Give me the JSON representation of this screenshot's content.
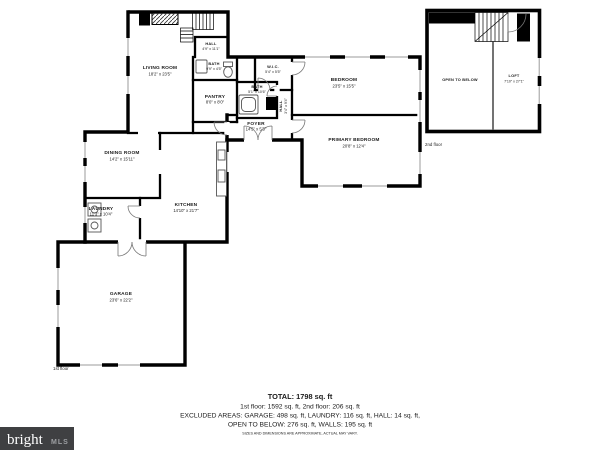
{
  "branding": {
    "name": "bright",
    "suffix": "MLS"
  },
  "floorplan": {
    "first_floor": {
      "floor_label": "1st floor",
      "rooms": [
        {
          "name": "LIVING ROOM",
          "dims": "18'2\" x 23'5\""
        },
        {
          "name": "HALL",
          "dims": "4'9\" x 11'1\""
        },
        {
          "name": "BATH",
          "dims": "9'9\" x 4'5\""
        },
        {
          "name": "PANTRY",
          "dims": "8'0\" x 8'0\""
        },
        {
          "name": "W.I.C.",
          "dims": "5'4\" x 5'5\""
        },
        {
          "name": "BEDROOM",
          "dims": "23'5\" x 15'5\""
        },
        {
          "name": "BATH",
          "dims": "5'1\" x 10'6\""
        },
        {
          "name": "HALL",
          "dims": "3'4\" x 9'4\""
        },
        {
          "name": "FOYER",
          "dims": "14'5\" x 5'3\""
        },
        {
          "name": "PRIMARY BEDROOM",
          "dims": "20'8\" x 12'4\""
        },
        {
          "name": "DINING ROOM",
          "dims": "14'2\" x 15'11\""
        },
        {
          "name": "LAUNDRY",
          "dims": "11'3\" x 10'4\""
        },
        {
          "name": "KITCHEN",
          "dims": "14'10\" x 21'7\""
        },
        {
          "name": "GARAGE",
          "dims": "23'6\" x 22'2\""
        }
      ]
    },
    "second_floor": {
      "floor_label": "2nd floor",
      "rooms": [
        {
          "name": "OPEN TO BELOW",
          "dims": ""
        },
        {
          "name": "LOFT",
          "dims": "7'10\" x 27'1\""
        }
      ]
    }
  },
  "summary": {
    "total": "TOTAL: 1798 sq. ft",
    "floors": "1st floor: 1592 sq. ft, 2nd floor: 206 sq. ft",
    "excluded_1": "EXCLUDED AREAS: GARAGE: 498 sq. ft, LAUNDRY: 116 sq. ft, HALL: 14 sq. ft,",
    "excluded_2": "OPEN TO BELOW: 276 sq. ft, WALLS: 195 sq. ft",
    "disclaimer": "SIZES AND DIMENSIONS ARE APPROXIMATE, ACTUAL MAY VARY."
  },
  "colors": {
    "wall": "#000000",
    "window": "#9b9b9b",
    "logo_bar": "#3f4042",
    "logo_text": "#ffffff",
    "logo_suffix": "#9ea0a3"
  }
}
